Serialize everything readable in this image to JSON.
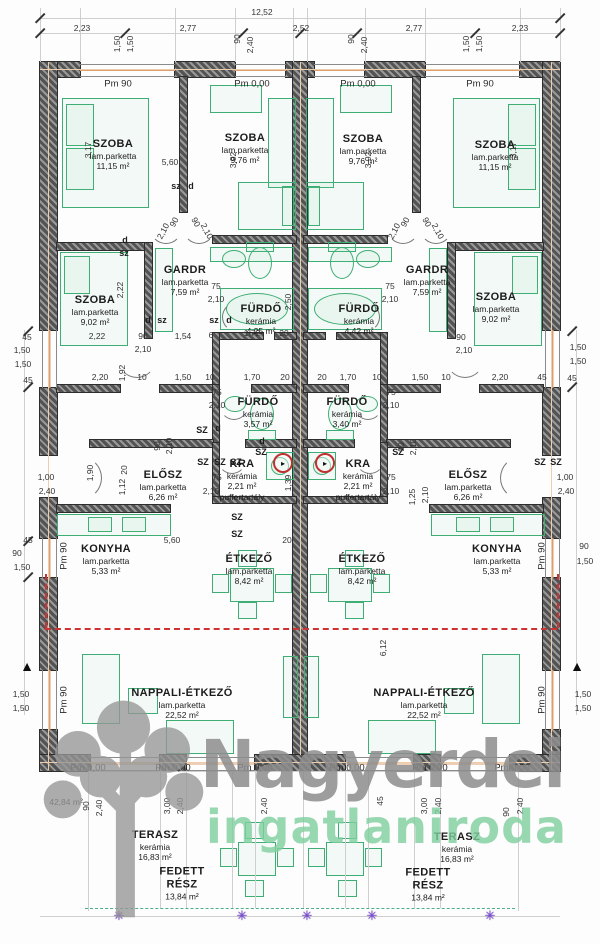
{
  "watermark": {
    "line1": "Nagyerdei",
    "line2": "ingatlaniroda"
  },
  "colors": {
    "wall": "#5a5a5a",
    "furniture_green": "#3fae74",
    "axis_orange": "#dd9f6e",
    "boundary_red": "#cf3232",
    "terrace_green_dash": "#49ae89",
    "survey_marker_purple": "#7b4fd8",
    "watermark_gray": "#8d8d8d",
    "watermark_green": "#7fcf9f"
  },
  "rooms": [
    {
      "name": "SZOBA",
      "material": "lam.parketta",
      "area": "11,15 m²",
      "unit": "left",
      "x": 113,
      "y": 155
    },
    {
      "name": "SZOBA",
      "material": "lam.parketta",
      "area": "9,76 m²",
      "unit": "left",
      "x": 245,
      "y": 149
    },
    {
      "name": "GARDR",
      "material": "lam.parketta",
      "area": "7,59 m²",
      "unit": "left",
      "x": 185,
      "y": 281
    },
    {
      "name": "SZOBA",
      "material": "lam.parketta",
      "area": "9,02 m²",
      "unit": "left",
      "x": 95,
      "y": 311
    },
    {
      "name": "FÜRDŐ",
      "material": "kerámia",
      "area": "4,25 m²",
      "unit": "left",
      "x": 261,
      "y": 320
    },
    {
      "name": "FÜRDŐ",
      "material": "kerámia",
      "area": "3,57 m²",
      "unit": "left",
      "x": 258,
      "y": 413
    },
    {
      "name": "KRA",
      "material": "kerámia",
      "area": "2,21 m²",
      "extra": "puffertartály",
      "unit": "left",
      "x": 242,
      "y": 480
    },
    {
      "name": "ELŐSZ",
      "material": "lam.parketta",
      "area": "6,26 m²",
      "unit": "left",
      "x": 163,
      "y": 486
    },
    {
      "name": "KONYHA",
      "material": "lam.parketta",
      "area": "5,33 m²",
      "unit": "left",
      "x": 106,
      "y": 560
    },
    {
      "name": "ÉTKEZŐ",
      "material": "lam.parketta",
      "area": "8,42 m²",
      "unit": "left",
      "x": 249,
      "y": 570
    },
    {
      "name": "NAPPALI-ÉTKEZŐ",
      "material": "lam.parketta",
      "area": "22,52 m²",
      "unit": "left",
      "x": 182,
      "y": 704
    },
    {
      "name": "TERASZ",
      "material": "kerámia",
      "area": "16,83 m²",
      "unit": "left",
      "x": 155,
      "y": 846
    },
    {
      "name": "FEDETT\nRÉSZ",
      "material": "",
      "area": "13,84 m²",
      "unit": "left",
      "x": 182,
      "y": 884
    },
    {
      "name": "SZOBA",
      "material": "lam.parketta",
      "area": "9,76 m²",
      "unit": "right",
      "x": 363,
      "y": 150
    },
    {
      "name": "SZOBA",
      "material": "lam.parketta",
      "area": "11,15 m²",
      "unit": "right",
      "x": 495,
      "y": 156
    },
    {
      "name": "GARDR",
      "material": "lam.parketta",
      "area": "7,59 m²",
      "unit": "right",
      "x": 427,
      "y": 281
    },
    {
      "name": "FÜRDŐ",
      "material": "kerámia",
      "area": "4,42 m²",
      "unit": "right",
      "x": 359,
      "y": 320
    },
    {
      "name": "SZOBA",
      "material": "lam.parketta",
      "area": "9,02 m²",
      "unit": "right",
      "x": 496,
      "y": 308
    },
    {
      "name": "FÜRDŐ",
      "material": "kerámia",
      "area": "3,40 m²",
      "unit": "right",
      "x": 347,
      "y": 413
    },
    {
      "name": "KRA",
      "material": "kerámia",
      "area": "2,21 m²",
      "extra": "puffertartály",
      "unit": "right",
      "x": 358,
      "y": 480
    },
    {
      "name": "ELŐSZ",
      "material": "lam.parketta",
      "area": "6,26 m²",
      "unit": "right",
      "x": 468,
      "y": 486
    },
    {
      "name": "KONYHA",
      "material": "lam.parketta",
      "area": "5,33 m²",
      "unit": "right",
      "x": 497,
      "y": 560
    },
    {
      "name": "ÉTKEZŐ",
      "material": "lam.parketta",
      "area": "8,42 m²",
      "unit": "right",
      "x": 362,
      "y": 570
    },
    {
      "name": "NAPPALI-ÉTKEZŐ",
      "material": "lam.parketta",
      "area": "22,52 m²",
      "unit": "right",
      "x": 424,
      "y": 704
    },
    {
      "name": "TERASZ",
      "material": "kerámia",
      "area": "16,83 m²",
      "unit": "right",
      "x": 457,
      "y": 848
    },
    {
      "name": "FEDETT\nRÉSZ",
      "material": "",
      "area": "13,84 m²",
      "unit": "right",
      "x": 428,
      "y": 885
    }
  ],
  "level_marks": [
    {
      "t": "Pm 90",
      "x": 118,
      "y": 84
    },
    {
      "t": "Pm 0,00",
      "x": 252,
      "y": 84
    },
    {
      "t": "Pm 0,00",
      "x": 358,
      "y": 84
    },
    {
      "t": "Pm 90",
      "x": 480,
      "y": 84
    },
    {
      "t": "Pm 0,00",
      "x": 88,
      "y": 768
    },
    {
      "t": "Pm 0,00",
      "x": 173,
      "y": 768
    },
    {
      "t": "Pm 0,00",
      "x": 255,
      "y": 768
    },
    {
      "t": "Pm 0,00",
      "x": 347,
      "y": 768
    },
    {
      "t": "Pm 0,00",
      "x": 430,
      "y": 768
    },
    {
      "t": "Pm 0,00",
      "x": 512,
      "y": 768
    },
    {
      "t": "Pm 90",
      "x": 64,
      "y": 556,
      "r": -90
    },
    {
      "t": "Pm 90",
      "x": 64,
      "y": 700,
      "r": -90
    },
    {
      "t": "Pm 90",
      "x": 542,
      "y": 556,
      "r": -90
    },
    {
      "t": "Pm 90",
      "x": 542,
      "y": 700,
      "r": -90
    }
  ],
  "dimensions": [
    {
      "t": "12,52",
      "x": 262,
      "y": 12
    },
    {
      "t": "2,23",
      "x": 82,
      "y": 28
    },
    {
      "t": "2,77",
      "x": 188,
      "y": 28
    },
    {
      "t": "2,52",
      "x": 301,
      "y": 28
    },
    {
      "t": "2,77",
      "x": 414,
      "y": 28
    },
    {
      "t": "2,23",
      "x": 520,
      "y": 28
    },
    {
      "t": "1,50",
      "x": 117,
      "y": 44,
      "r": -90
    },
    {
      "t": "1,50",
      "x": 130,
      "y": 44,
      "r": -90
    },
    {
      "t": "90",
      "x": 237,
      "y": 39,
      "r": -90
    },
    {
      "t": "2,40",
      "x": 250,
      "y": 45,
      "r": -90
    },
    {
      "t": "90",
      "x": 351,
      "y": 39,
      "r": -90
    },
    {
      "t": "2,40",
      "x": 364,
      "y": 45,
      "r": -90
    },
    {
      "t": "1,50",
      "x": 466,
      "y": 44,
      "r": -90
    },
    {
      "t": "1,50",
      "x": 479,
      "y": 44,
      "r": -90
    },
    {
      "t": "45",
      "x": 27,
      "y": 337
    },
    {
      "t": "1,50",
      "x": 22,
      "y": 350
    },
    {
      "t": "1,50",
      "x": 23,
      "y": 364
    },
    {
      "t": "45",
      "x": 28,
      "y": 380
    },
    {
      "t": "1,00",
      "x": 46,
      "y": 477
    },
    {
      "t": "2,40",
      "x": 47,
      "y": 491
    },
    {
      "t": "45",
      "x": 28,
      "y": 540
    },
    {
      "t": "90",
      "x": 17,
      "y": 553
    },
    {
      "t": "1,50",
      "x": 22,
      "y": 567
    },
    {
      "t": "1,50",
      "x": 21,
      "y": 694
    },
    {
      "t": "1,50",
      "x": 21,
      "y": 708
    },
    {
      "t": "42,84 m²",
      "x": 66,
      "y": 802
    },
    {
      "t": "1,50",
      "x": 578,
      "y": 347
    },
    {
      "t": "1,50",
      "x": 578,
      "y": 361
    },
    {
      "t": "45",
      "x": 572,
      "y": 378
    },
    {
      "t": "1,00",
      "x": 565,
      "y": 477
    },
    {
      "t": "2,40",
      "x": 566,
      "y": 491
    },
    {
      "t": "90",
      "x": 584,
      "y": 546
    },
    {
      "t": "1,50",
      "x": 585,
      "y": 561
    },
    {
      "t": "1,50",
      "x": 583,
      "y": 694
    },
    {
      "t": "1,50",
      "x": 583,
      "y": 708
    },
    {
      "t": "90",
      "x": 86,
      "y": 806,
      "r": -90
    },
    {
      "t": "2,40",
      "x": 99,
      "y": 808,
      "r": -90
    },
    {
      "t": "3,00",
      "x": 167,
      "y": 806,
      "r": -90
    },
    {
      "t": "2,40",
      "x": 180,
      "y": 806,
      "r": -90
    },
    {
      "t": "2,40",
      "x": 264,
      "y": 806,
      "r": -90
    },
    {
      "t": "45",
      "x": 380,
      "y": 801,
      "r": -90
    },
    {
      "t": "3,00",
      "x": 424,
      "y": 806,
      "r": -90
    },
    {
      "t": "2,40",
      "x": 438,
      "y": 806,
      "r": -90
    },
    {
      "t": "90",
      "x": 506,
      "y": 812,
      "r": -90
    },
    {
      "t": "2,40",
      "x": 520,
      "y": 806,
      "r": -90
    },
    {
      "t": "3,17",
      "x": 88,
      "y": 150,
      "r": -90
    },
    {
      "t": "5,60",
      "x": 170,
      "y": 162
    },
    {
      "t": "3,92",
      "x": 233,
      "y": 160,
      "r": -90
    },
    {
      "t": "3,92",
      "x": 368,
      "y": 160,
      "r": -90
    },
    {
      "t": "3,17",
      "x": 513,
      "y": 150,
      "r": -90
    },
    {
      "t": "2,10",
      "x": 163,
      "y": 231,
      "r": -62
    },
    {
      "t": "90",
      "x": 174,
      "y": 222,
      "r": -62
    },
    {
      "t": "90",
      "x": 196,
      "y": 222,
      "r": 62
    },
    {
      "t": "2,10",
      "x": 207,
      "y": 231,
      "r": 62
    },
    {
      "t": "2,10",
      "x": 394,
      "y": 231,
      "r": -62
    },
    {
      "t": "90",
      "x": 405,
      "y": 222,
      "r": -62
    },
    {
      "t": "90",
      "x": 427,
      "y": 222,
      "r": 62
    },
    {
      "t": "2,10",
      "x": 438,
      "y": 231,
      "r": 62
    },
    {
      "t": "75",
      "x": 216,
      "y": 286
    },
    {
      "t": "2,10",
      "x": 216,
      "y": 299
    },
    {
      "t": "75",
      "x": 390,
      "y": 286
    },
    {
      "t": "2,10",
      "x": 390,
      "y": 299
    },
    {
      "t": "2,22",
      "x": 120,
      "y": 290,
      "r": -90
    },
    {
      "t": "2,22",
      "x": 97,
      "y": 336
    },
    {
      "t": "1,54",
      "x": 183,
      "y": 336
    },
    {
      "t": "6",
      "x": 211,
      "y": 335
    },
    {
      "t": "1,72",
      "x": 252,
      "y": 333
    },
    {
      "t": "20",
      "x": 284,
      "y": 333
    },
    {
      "t": "2,50",
      "x": 288,
      "y": 302,
      "r": -90
    },
    {
      "t": "90",
      "x": 143,
      "y": 336
    },
    {
      "t": "2,10",
      "x": 143,
      "y": 349
    },
    {
      "t": "90",
      "x": 461,
      "y": 337
    },
    {
      "t": "2,10",
      "x": 464,
      "y": 350
    },
    {
      "t": "2,20",
      "x": 100,
      "y": 377
    },
    {
      "t": "1,92",
      "x": 122,
      "y": 373,
      "r": -90
    },
    {
      "t": "10",
      "x": 142,
      "y": 377
    },
    {
      "t": "1,50",
      "x": 183,
      "y": 377
    },
    {
      "t": "10",
      "x": 210,
      "y": 377
    },
    {
      "t": "1,70",
      "x": 252,
      "y": 377
    },
    {
      "t": "20",
      "x": 285,
      "y": 377
    },
    {
      "t": "20",
      "x": 322,
      "y": 377
    },
    {
      "t": "1,70",
      "x": 348,
      "y": 377
    },
    {
      "t": "10",
      "x": 377,
      "y": 377
    },
    {
      "t": "1,50",
      "x": 420,
      "y": 377
    },
    {
      "t": "10",
      "x": 446,
      "y": 377
    },
    {
      "t": "2,20",
      "x": 500,
      "y": 377
    },
    {
      "t": "45",
      "x": 542,
      "y": 377
    },
    {
      "t": "75",
      "x": 217,
      "y": 392
    },
    {
      "t": "2,10",
      "x": 217,
      "y": 405
    },
    {
      "t": "75",
      "x": 391,
      "y": 392
    },
    {
      "t": "2,10",
      "x": 391,
      "y": 405
    },
    {
      "t": "75",
      "x": 217,
      "y": 477
    },
    {
      "t": "2,10",
      "x": 211,
      "y": 491
    },
    {
      "t": "75",
      "x": 391,
      "y": 477
    },
    {
      "t": "2,10",
      "x": 391,
      "y": 491
    },
    {
      "t": "1,39",
      "x": 288,
      "y": 483,
      "r": -90
    },
    {
      "t": "1,90",
      "x": 90,
      "y": 473,
      "r": -90
    },
    {
      "t": "20",
      "x": 124,
      "y": 470,
      "r": -90
    },
    {
      "t": "1,12",
      "x": 122,
      "y": 487,
      "r": -90
    },
    {
      "t": "90",
      "x": 157,
      "y": 446,
      "r": -90
    },
    {
      "t": "2,10",
      "x": 169,
      "y": 446,
      "r": -90
    },
    {
      "t": "90",
      "x": 401,
      "y": 447,
      "r": -90
    },
    {
      "t": "2,10",
      "x": 413,
      "y": 447,
      "r": -90
    },
    {
      "t": "1,25",
      "x": 412,
      "y": 497,
      "r": -90
    },
    {
      "t": "2,10",
      "x": 425,
      "y": 495,
      "r": -90
    },
    {
      "t": "5,60",
      "x": 172,
      "y": 540
    },
    {
      "t": "20",
      "x": 287,
      "y": 540
    },
    {
      "t": "6,12",
      "x": 383,
      "y": 648,
      "r": -90
    }
  ],
  "tags": [
    {
      "t": "sz",
      "x": 176,
      "y": 186
    },
    {
      "t": "d",
      "x": 191,
      "y": 186
    },
    {
      "t": "d",
      "x": 125,
      "y": 240
    },
    {
      "t": "sz",
      "x": 124,
      "y": 253
    },
    {
      "t": "d",
      "x": 148,
      "y": 320
    },
    {
      "t": "sz",
      "x": 162,
      "y": 320
    },
    {
      "t": "sz",
      "x": 214,
      "y": 320
    },
    {
      "t": "d",
      "x": 229,
      "y": 320
    },
    {
      "t": "SZ",
      "x": 202,
      "y": 430
    },
    {
      "t": "d",
      "x": 218,
      "y": 428
    },
    {
      "t": "d",
      "x": 262,
      "y": 441
    },
    {
      "t": "SZ",
      "x": 203,
      "y": 462
    },
    {
      "t": "SZ",
      "x": 220,
      "y": 462
    },
    {
      "t": "SZ",
      "x": 236,
      "y": 462
    },
    {
      "t": "SZ",
      "x": 261,
      "y": 452
    },
    {
      "t": "SZ",
      "x": 237,
      "y": 517
    },
    {
      "t": "SZ",
      "x": 237,
      "y": 534
    },
    {
      "t": "SZ",
      "x": 398,
      "y": 452
    },
    {
      "t": "SZ",
      "x": 540,
      "y": 462
    },
    {
      "t": "SZ",
      "x": 556,
      "y": 462
    }
  ],
  "markers": [
    {
      "type": "level-triangle-icon",
      "x": 27,
      "y": 666
    },
    {
      "type": "level-triangle-icon",
      "x": 577,
      "y": 666
    },
    {
      "type": "boiler-circle-icon",
      "x": 283,
      "y": 463
    },
    {
      "type": "boiler-circle-icon",
      "x": 325,
      "y": 463
    },
    {
      "type": "survey-star-icon",
      "x": 119,
      "y": 916
    },
    {
      "type": "survey-star-icon",
      "x": 242,
      "y": 916
    },
    {
      "type": "survey-star-icon",
      "x": 307,
      "y": 916
    },
    {
      "type": "survey-star-icon",
      "x": 372,
      "y": 916
    },
    {
      "type": "survey-star-icon",
      "x": 490,
      "y": 916
    }
  ]
}
